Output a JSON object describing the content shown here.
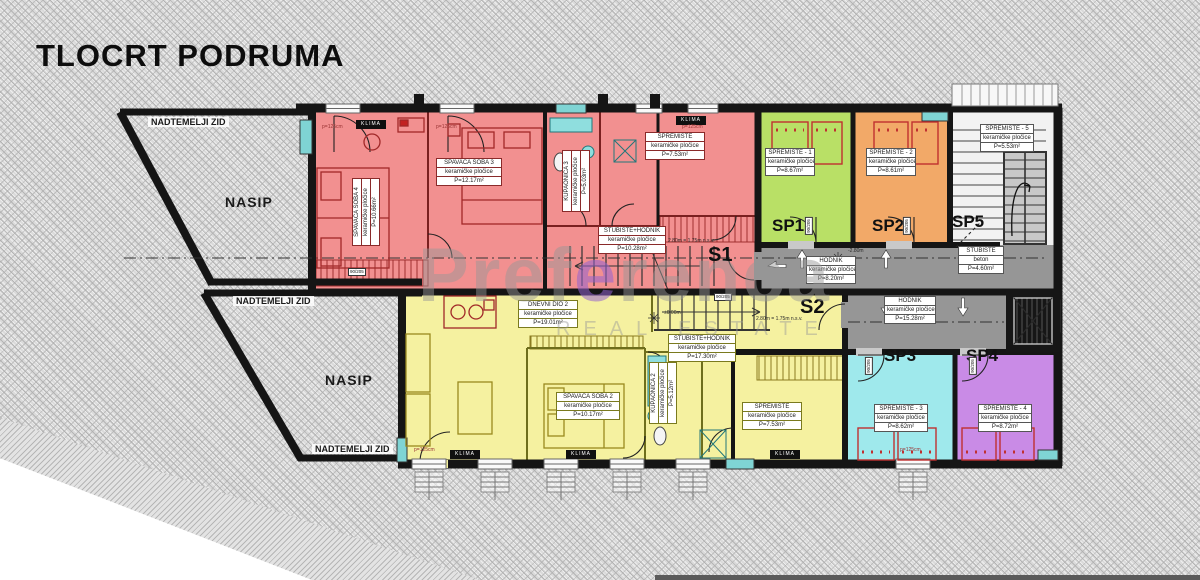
{
  "title": "TLOCRT PODRUMA",
  "watermark": {
    "part1": "Pref",
    "accent": "e",
    "part2": "renca",
    "tagline": "REAL ESTATE"
  },
  "site": {
    "wall1": "NADTEMELJI ZID",
    "wall2": "NADTEMELJI ZID",
    "wall3": "NADTEMELJI ZID",
    "fill1": "NASIP",
    "fill2": "NASIP"
  },
  "units": {
    "s1": {
      "code": "S1",
      "bedroom4": {
        "name": "SPAVAĆA SOBA 4",
        "material": "keramičke pločice",
        "area": "P=10.66m²"
      },
      "bedroom3": {
        "name": "SPAVAĆA SOBA 3",
        "material": "keramičke pločice",
        "area": "P=12.17m²"
      },
      "bathroom": {
        "name": "KUPAONICA 3",
        "material": "keramičke pločice",
        "area": "P=5.03m²"
      },
      "storage": {
        "name": "SPREMIŠTE",
        "material": "keramičke pločice",
        "area": "P=7.53m²"
      },
      "hall": {
        "name": "STUBIŠTE+HODNIK",
        "material": "keramičke pločice",
        "area": "P=10.28m²"
      }
    },
    "s2": {
      "code": "S2",
      "living": {
        "name": "DNEVNI DIO 2",
        "material": "keramičke pločice",
        "area": "P=19.01m²"
      },
      "bedroom2": {
        "name": "SPAVAĆA SOBA 2",
        "material": "keramičke pločice",
        "area": "P=10.17m²"
      },
      "bathroom": {
        "name": "KUPAONICA 2",
        "material": "keramičke pločice",
        "area": "P=5.12m²"
      },
      "storage": {
        "name": "SPREMIŠTE",
        "material": "keramičke pločice",
        "area": "P=7.53m²"
      },
      "hall": {
        "name": "STUBIŠTE+HODNIK",
        "material": "keramičke pločice",
        "area": "P=17.30m²"
      }
    },
    "sp1": {
      "code": "SP1",
      "name": "SPREMIŠTE - 1",
      "material": "keramičke pločice",
      "area": "P=8.67m²"
    },
    "sp2": {
      "code": "SP2",
      "name": "SPREMIŠTE - 2",
      "material": "keramičke pločice",
      "area": "P=8.61m²"
    },
    "sp3": {
      "code": "SP3",
      "name": "SPREMIŠTE - 3",
      "material": "keramičke pločice",
      "area": "P=8.62m²"
    },
    "sp4": {
      "code": "SP4",
      "name": "SPREMIŠTE - 4",
      "material": "keramičke pločice",
      "area": "P=8.72m²"
    },
    "sp5": {
      "code": "SP5",
      "name": "SPREMIŠTE - 5",
      "material": "keramičke pločice",
      "area": "P=5.53m²"
    }
  },
  "common": {
    "hall_upper": {
      "name": "HODNIK",
      "material": "keramičke pločice",
      "area": "P=8.20m²"
    },
    "hall_lower": {
      "name": "HODNIK",
      "material": "keramičke pločice",
      "area": "P=15.28m²"
    },
    "stairwell": {
      "name": "STUBIŠTE",
      "material": "beton",
      "area": "P=4.60m²"
    }
  },
  "annotations": {
    "klima": "KLIMA",
    "window_width": "p=125cm",
    "door_size": "90/205",
    "level_upper": "-2.80m",
    "level_zero": "±0.00m",
    "headroom": "2.80m = 1.75m n.s.v."
  },
  "colors": {
    "s1": "#f29090",
    "s2": "#f5f1a0",
    "sp1": "#b9e066",
    "sp2": "#f2a968",
    "sp3": "#9fe9ec",
    "sp4": "#c98be6",
    "sp5": "#f2f2f2",
    "corridor": "#969696",
    "wall": "#151515",
    "window": "#7fd4d4"
  }
}
